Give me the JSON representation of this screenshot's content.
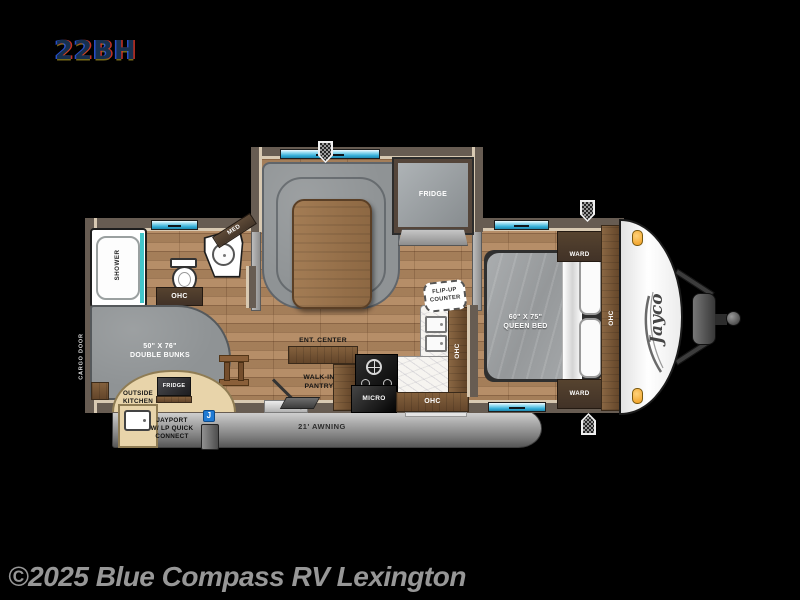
{
  "page": {
    "model": "22BH",
    "watermark": "©2025 Blue Compass RV Lexington"
  },
  "floorplan": {
    "brand_logo": "Jayco",
    "exterior": {
      "awning": "21' AWNING",
      "cargo_door": "CARGO DOOR",
      "jayport": {
        "icon": "J",
        "line1": "JAYPORT",
        "line2": "W/ LP QUICK",
        "line3": "CONNECT"
      },
      "outside_kitchen": {
        "line1": "OUTSIDE",
        "line2": "KITCHEN",
        "fridge": "FRIDGE"
      }
    },
    "bathroom": {
      "shower": "SHOWER",
      "med_cabinet": "MED",
      "ohc": "OHC"
    },
    "bunkroom": {
      "size": "50\" X 76\"",
      "name": "DOUBLE BUNKS"
    },
    "living": {
      "ent_center": "ENT. CENTER",
      "pantry_line1": "WALK-IN",
      "pantry_line2": "PANTRY"
    },
    "kitchen": {
      "fridge": "FRIDGE",
      "micro": "MICRO",
      "ohc_side": "OHC",
      "ohc_bottom": "OHC",
      "flip_counter_line1": "FLIP-UP",
      "flip_counter_line2": "COUNTER"
    },
    "bedroom": {
      "size": "60\" X 75\"",
      "name": "QUEEN BED",
      "ward_top": "WARD",
      "ward_bottom": "WARD",
      "ohc": "OHC"
    }
  },
  "colors": {
    "background": "#000000",
    "wood_floor": "#b08760",
    "wall": "#675c52",
    "wall_trim": "#d8c9b2",
    "cabinet_wood": "#84613d",
    "cushion_gray": "#8f9395",
    "window_blue": "#35aed8",
    "awning_gray": "#9c9c9c",
    "jayport_blue": "#1f7ad4",
    "marker_light": "#ef9c1e"
  }
}
